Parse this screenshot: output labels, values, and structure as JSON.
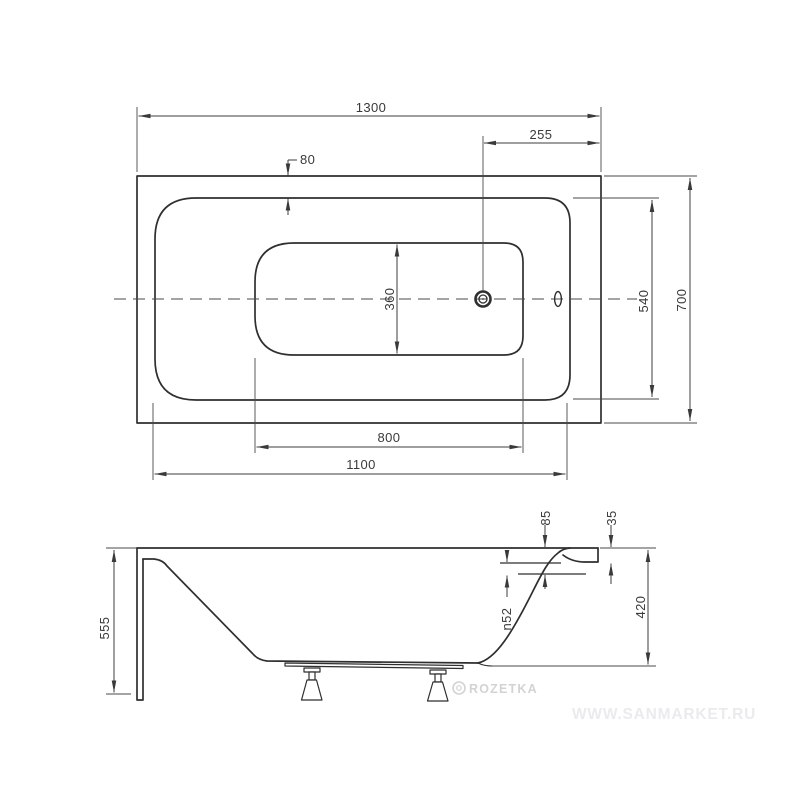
{
  "top_view": {
    "overall_length": "1300",
    "drain_to_right_edge": "255",
    "rim_margin": "80",
    "basin_width_at_drain": "360",
    "inner_width": "540",
    "overall_width": "700",
    "basin_bottom_length": "800",
    "basin_top_length": "1100"
  },
  "side_view": {
    "total_height": "555",
    "rim_to_overflow": "85",
    "rim_edge_thickness": "35",
    "overflow_diameter": "n52",
    "shell_depth": "420"
  },
  "watermarks": {
    "logo_text": "ROZETKA",
    "site_url": "WWW.SANMARKET.RU"
  },
  "colors": {
    "outline": "#2f2f2f",
    "dimension": "#3d3d3d",
    "watermark_logo": "#d3d3d3",
    "watermark_site": "#e9ebec"
  }
}
